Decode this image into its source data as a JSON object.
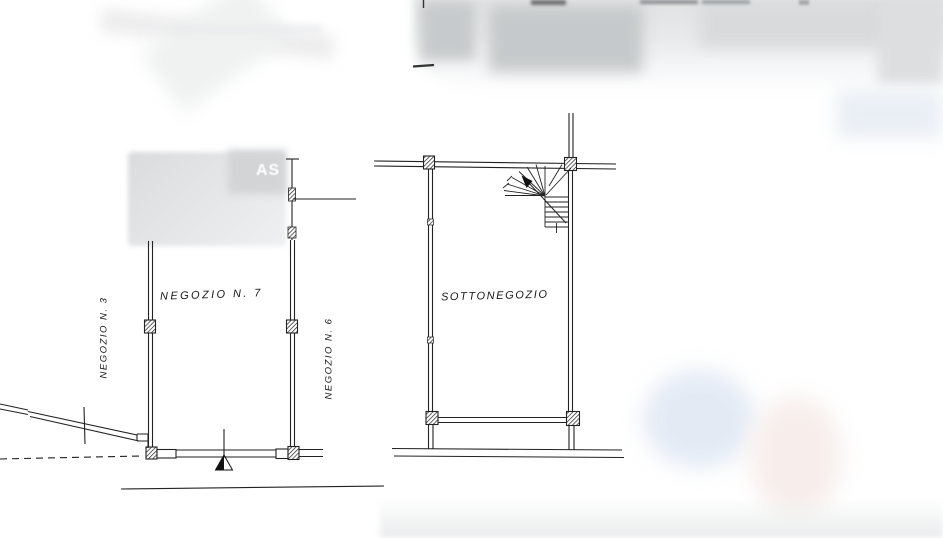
{
  "document": {
    "kind": "scanned cadastral floor plan (planimetria)",
    "language": "Italian"
  },
  "labels": {
    "left_unit": "NEGOZIO N. 7",
    "left_neighbor": "NEGOZIO N. 3",
    "right_neighbor": "NEGOZIO N. 6",
    "basement_unit": "SOTTONEGOZIO"
  },
  "watermark": {
    "partial_text": "AS"
  },
  "colors": {
    "ink": "#1f1f1f",
    "paper": "#ffffff",
    "redaction_gray": "#c9ccce",
    "blur_blue": "#dfe7f3",
    "blur_peach": "#f7eeeb"
  }
}
